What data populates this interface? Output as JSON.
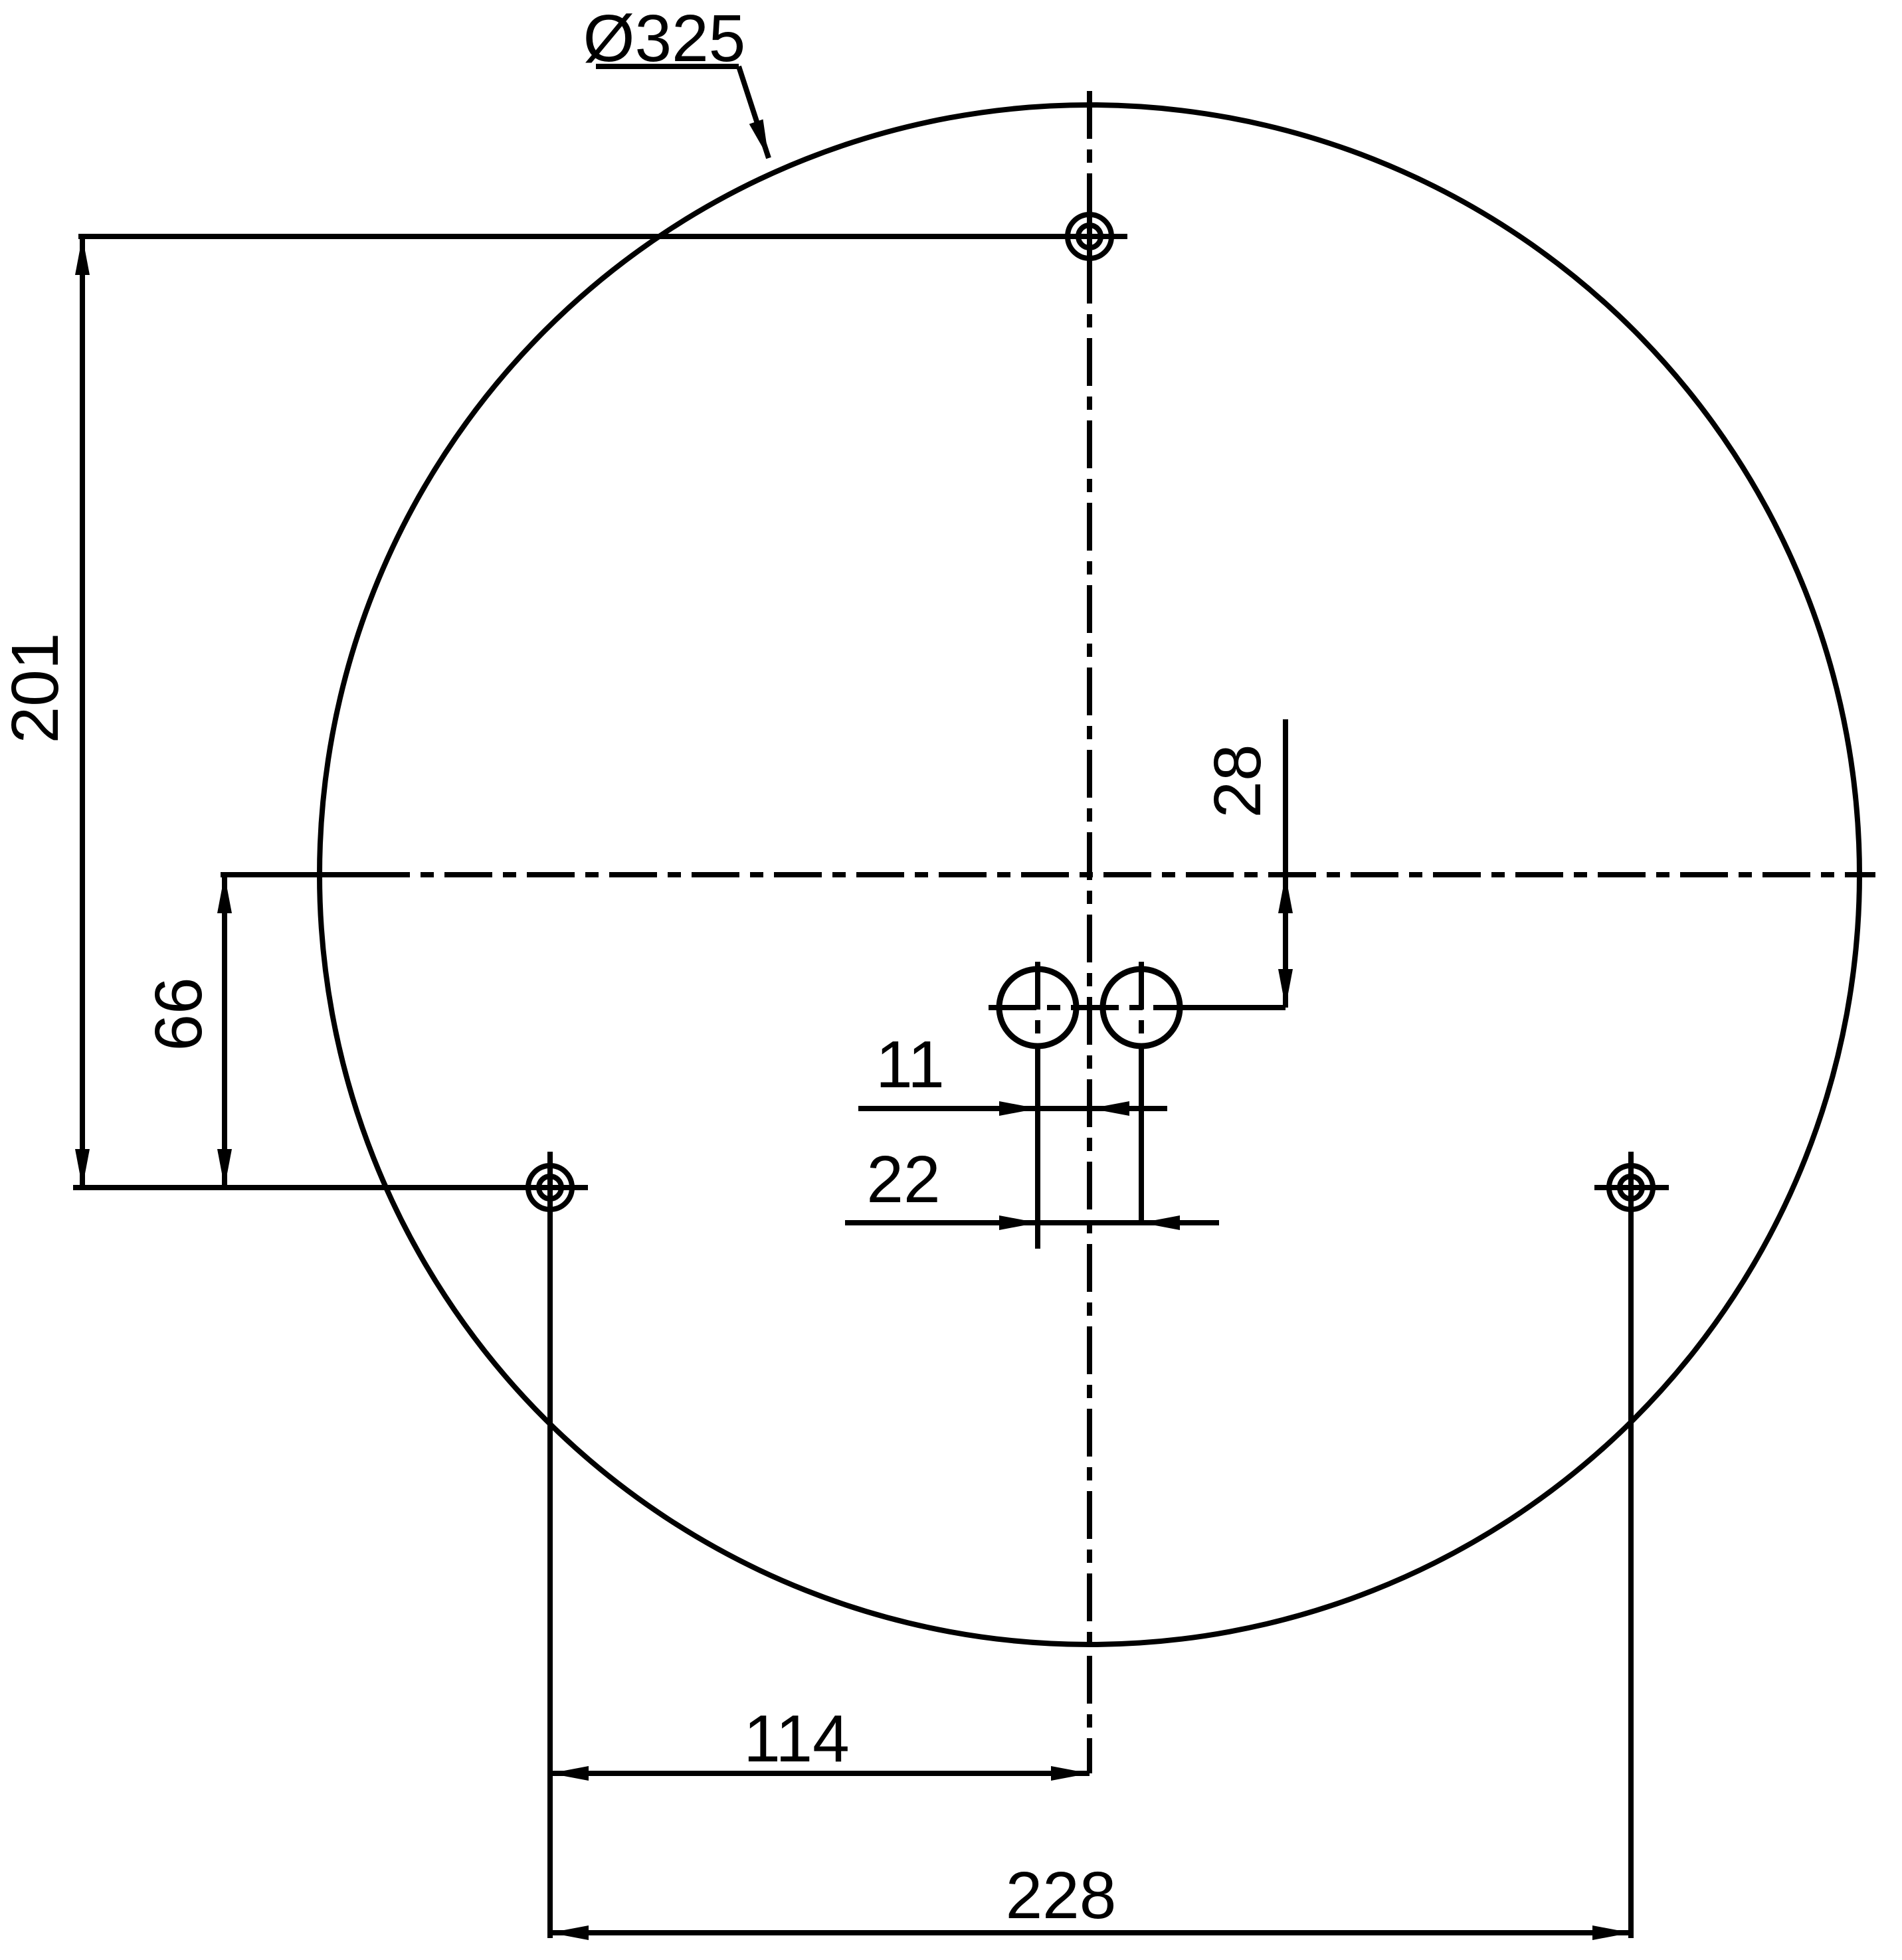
{
  "drawing": {
    "type": "technical-dimension-drawing",
    "labels": {
      "diameter": "Ø325",
      "dim_201": "201",
      "dim_66": "66",
      "dim_28": "28",
      "dim_11": "11",
      "dim_22": "22",
      "dim_114": "114",
      "dim_228": "228"
    },
    "dimensions_mm": {
      "outer_diameter": 325,
      "top_hole_to_bottom_holes_vertical": 201,
      "centerline_to_bottom_holes_vertical": 66,
      "centerline_to_small_holes_vertical": 28,
      "small_hole_offset_from_center": 11,
      "small_holes_center_to_center": 22,
      "bottom_left_hole_to_centerline": 114,
      "bottom_holes_center_to_center": 228
    },
    "colors": {
      "line": "#000000",
      "background": "#ffffff"
    }
  }
}
